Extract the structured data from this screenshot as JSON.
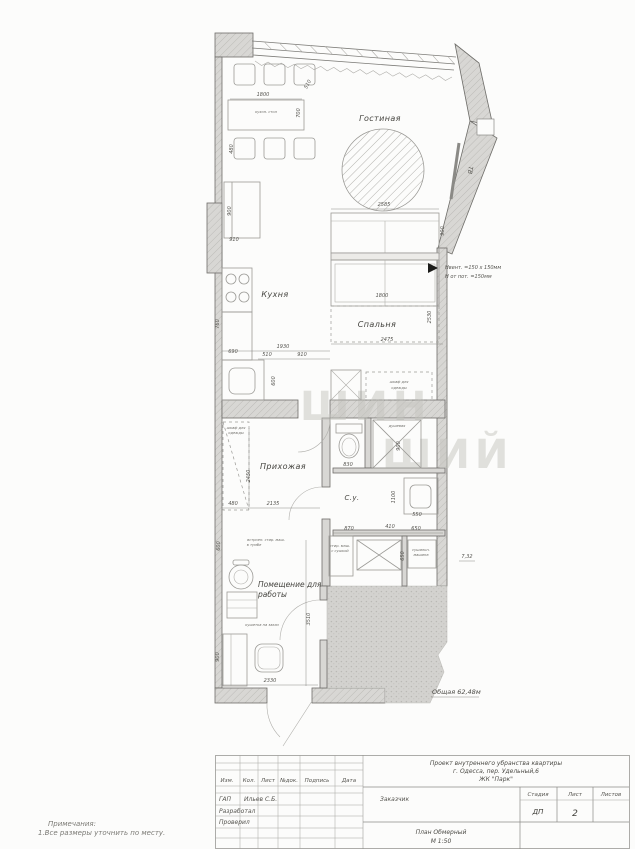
{
  "sheet": {
    "rooms": {
      "living": "Гостиная",
      "kitchen": "Кухня",
      "bedroom": "Спальня",
      "hall": "Прихожая",
      "bath": "С.у.",
      "work1": "Помещение для",
      "work2": "работы",
      "tv": "ТВ"
    },
    "annotations": {
      "vent1": "Нвент. =150 х 150мм",
      "vent2": "Н от пот. =150мм",
      "bath_area": "7,32",
      "total_area": "Общая 62,48м"
    },
    "watermark1": "ШИН",
    "watermark2": "ШИЙ",
    "dims": [
      {
        "t": "1800",
        "x": 263,
        "y": 96,
        "r": 0
      },
      {
        "t": "700",
        "x": 300,
        "y": 113,
        "r": -90
      },
      {
        "t": "510",
        "x": 309,
        "y": 85,
        "r": -62
      },
      {
        "t": "480",
        "x": 233,
        "y": 149,
        "r": -90
      },
      {
        "t": "900",
        "x": 231,
        "y": 211,
        "r": -90
      },
      {
        "t": "910",
        "x": 234,
        "y": 241,
        "r": 0
      },
      {
        "t": "2585",
        "x": 384,
        "y": 206,
        "r": 0
      },
      {
        "t": "900",
        "x": 444,
        "y": 231,
        "r": -90
      },
      {
        "t": "1800",
        "x": 382,
        "y": 297,
        "r": 0
      },
      {
        "t": "2530",
        "x": 431,
        "y": 317,
        "r": -90
      },
      {
        "t": "2475",
        "x": 387,
        "y": 341,
        "r": 0
      },
      {
        "t": "1930",
        "x": 283,
        "y": 348,
        "r": 0
      },
      {
        "t": "510",
        "x": 267,
        "y": 356,
        "r": 0
      },
      {
        "t": "910",
        "x": 302,
        "y": 356,
        "r": 0
      },
      {
        "t": "690",
        "x": 233,
        "y": 353,
        "r": 0
      },
      {
        "t": "600",
        "x": 275,
        "y": 381,
        "r": -90
      },
      {
        "t": "760",
        "x": 219,
        "y": 324,
        "r": -90
      },
      {
        "t": "2450",
        "x": 250,
        "y": 476,
        "r": -90
      },
      {
        "t": "480",
        "x": 233,
        "y": 505,
        "r": 0
      },
      {
        "t": "2135",
        "x": 273,
        "y": 505,
        "r": 0
      },
      {
        "t": "830",
        "x": 348,
        "y": 466,
        "r": 0
      },
      {
        "t": "900",
        "x": 400,
        "y": 446,
        "r": -90
      },
      {
        "t": "1100",
        "x": 395,
        "y": 497,
        "r": -90
      },
      {
        "t": "550",
        "x": 417,
        "y": 516,
        "r": 0
      },
      {
        "t": "870",
        "x": 349,
        "y": 530,
        "r": 0
      },
      {
        "t": "410",
        "x": 390,
        "y": 528,
        "r": 0
      },
      {
        "t": "650",
        "x": 416,
        "y": 530,
        "r": 0
      },
      {
        "t": "650",
        "x": 404,
        "y": 556,
        "r": -90
      },
      {
        "t": "600",
        "x": 220,
        "y": 546,
        "r": -90
      },
      {
        "t": "900",
        "x": 219,
        "y": 657,
        "r": -90
      },
      {
        "t": "2330",
        "x": 270,
        "y": 682,
        "r": 0
      },
      {
        "t": "3510",
        "x": 310,
        "y": 619,
        "r": -90
      }
    ],
    "micro": [
      {
        "t": "кухон. стол",
        "x": 266,
        "y": 113
      },
      {
        "t": "шкаф для",
        "x": 236,
        "y": 429
      },
      {
        "t": "одежды",
        "x": 236,
        "y": 434
      },
      {
        "t": "шкаф для",
        "x": 399,
        "y": 383
      },
      {
        "t": "одежды",
        "x": 399,
        "y": 389
      },
      {
        "t": "душевая",
        "x": 397,
        "y": 427
      },
      {
        "t": "стир. маш.",
        "x": 340,
        "y": 547
      },
      {
        "t": "с сушкой",
        "x": 340,
        "y": 552
      },
      {
        "t": "сушильн.",
        "x": 421,
        "y": 551
      },
      {
        "t": "машина",
        "x": 421,
        "y": 556
      },
      {
        "t": "встроен. стир. маш.",
        "x": 266,
        "y": 541
      },
      {
        "t": "в тумбе",
        "x": 254,
        "y": 546
      },
      {
        "t": "кушетка на заказ",
        "x": 262,
        "y": 626
      }
    ]
  },
  "notes": {
    "line1": "Примечания:",
    "line2": "1.Все размеры уточнить по месту."
  },
  "titleblock": {
    "header_cols": [
      "Изм.",
      "Кол.",
      "Лист",
      "№док.",
      "Подпись",
      "Дата"
    ],
    "sign_rows": [
      {
        "role": "ГАП",
        "name": "Ильев С.Б."
      },
      {
        "role": "Разработал",
        "name": ""
      },
      {
        "role": "Проверил",
        "name": ""
      }
    ],
    "project_line1": "Проект внутреннего убранства  квартиры",
    "project_line2": "г. Одесса, пер. Удельный,6",
    "project_line3": "ЖК \"Парк\"",
    "customer_label": "Заказчик",
    "stage_label": "Стадия",
    "sheet_label": "Лист",
    "sheets_label": "Листов",
    "stage_value": "ДП",
    "sheet_value": "2",
    "sheets_value": "",
    "doc_line1": "План Обмерный",
    "doc_line2": "М 1:50"
  }
}
